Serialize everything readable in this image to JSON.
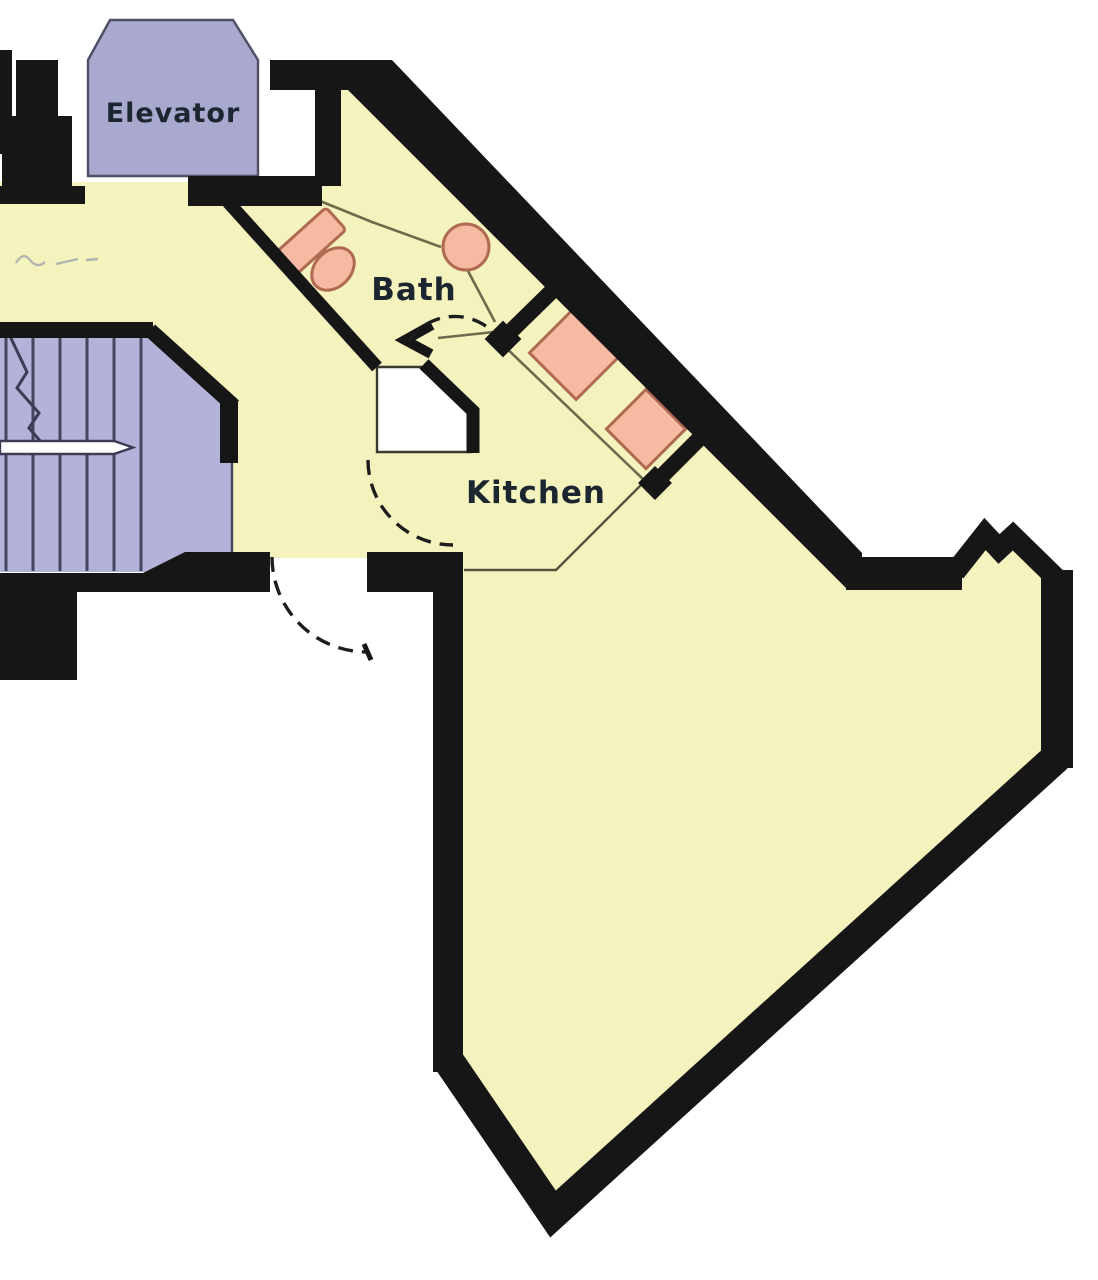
{
  "title": "Apartment floor plan",
  "rooms": {
    "elevator": {
      "label": "Elevator"
    },
    "bath": {
      "label": "Bath"
    },
    "kitchen": {
      "label": "Kitchen"
    }
  },
  "fixtures": {
    "bath": [
      "vanity-counter",
      "toilet",
      "wash-basin"
    ],
    "kitchen": [
      "appliance-1",
      "appliance-2"
    ],
    "stairwell": [
      "stair-treads",
      "handrail",
      "break-line"
    ]
  },
  "colors": {
    "background": "#ffffff",
    "floor": "#f5f3bd",
    "wall": "#161616",
    "elevator_fill": "#a9a9cf",
    "stairs_fill": "#b3b3da",
    "fixture_fill": "#f6b9a1",
    "fixture_stroke": "#b06a52",
    "closet_fill": "#ffffff",
    "label_text": "#1c2630"
  }
}
